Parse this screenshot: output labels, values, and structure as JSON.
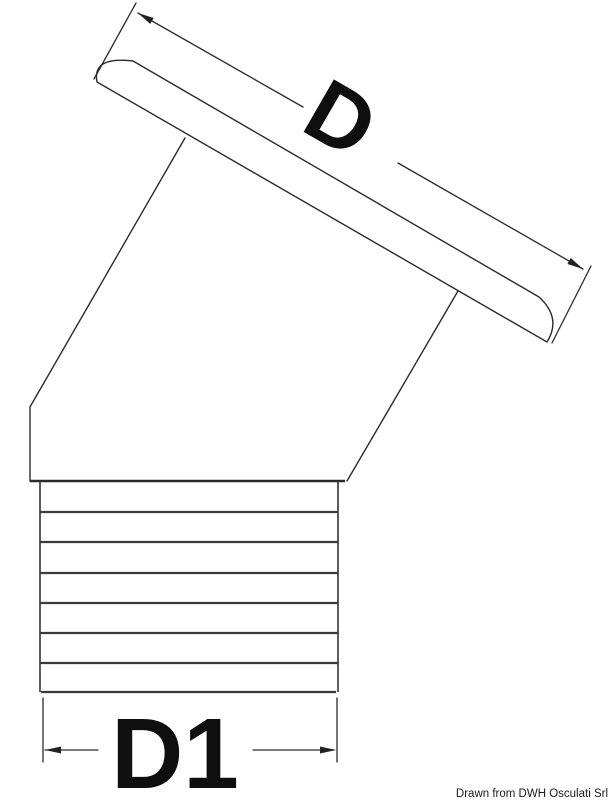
{
  "drawing": {
    "labels": {
      "top_diameter": "D",
      "bottom_diameter": "D1"
    },
    "credit": "Drawn from DWH Osculati Srl",
    "colors": {
      "line": "#2b2b2b",
      "background": "#ffffff",
      "text": "#0f0f0f"
    }
  }
}
